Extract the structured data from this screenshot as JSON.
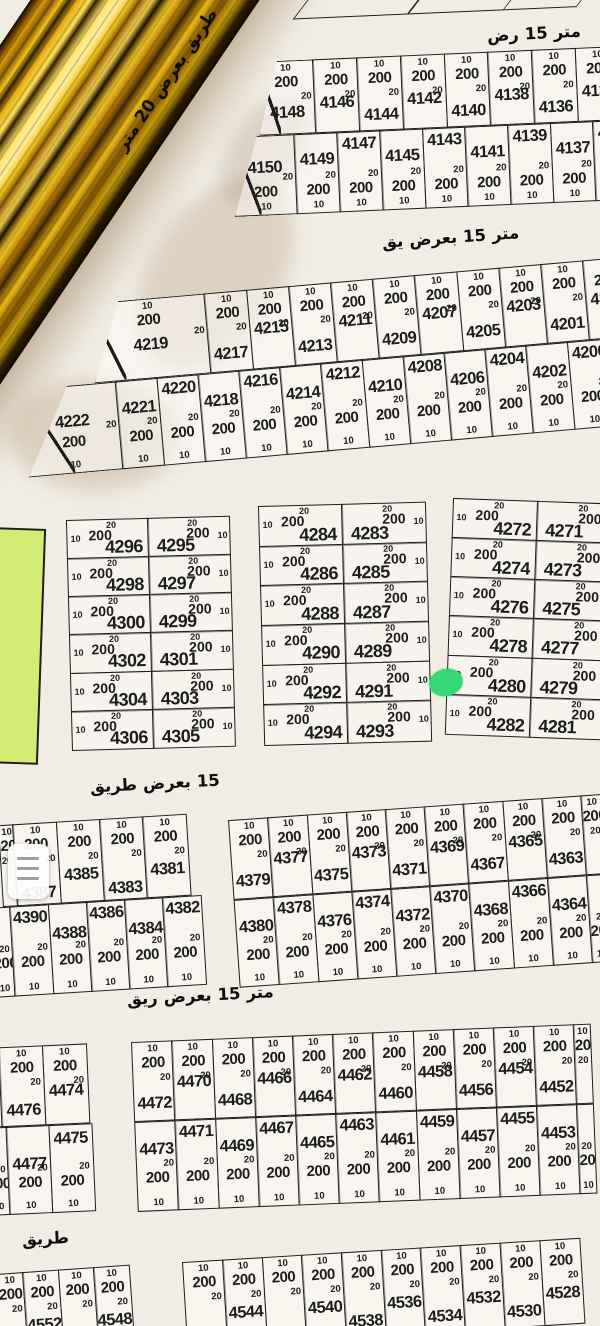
{
  "dims": {
    "frontage": "10",
    "area": "200",
    "depth": "20"
  },
  "colors": {
    "paper": "#f1ede5",
    "line": "#1d1d1d",
    "area_red": "#8e1b10",
    "green_rect": "#d3ec74",
    "marker_green": "#36d877",
    "gold_road": "#e8b113"
  },
  "roads": {
    "r20_diagonal": {
      "text": "طريق بعرض 20 متر"
    },
    "r15_top": {
      "words": [
        "رض",
        "15",
        "متر"
      ]
    },
    "r15_a": {
      "words": [
        "يق",
        "بعرض",
        "15",
        "متر"
      ]
    },
    "r15_b": {
      "words": [
        "طريق",
        "بعرض",
        "15"
      ]
    },
    "r15_c": {
      "words": [
        "ريق",
        "بعرض",
        "15",
        "متر"
      ]
    },
    "r_bottom": {
      "words": [
        "طريق"
      ]
    }
  },
  "menu_button": {
    "icon": "hamburger"
  },
  "marker": {
    "type": "highlight-dot",
    "near_plot": "4280"
  },
  "blocks": {
    "band_a": {
      "row_top": [
        "4148",
        "4146",
        "4144",
        "4142",
        "4140",
        "4138",
        "4136",
        "4134",
        "4132"
      ],
      "row_bottom": [
        "4150",
        "4149",
        "4147",
        "4145",
        "4143",
        "4141",
        "4139",
        "4137",
        "4135",
        "4133"
      ]
    },
    "band_b": {
      "row_top": [
        "4219",
        "4217",
        "4215",
        "4213",
        "4211",
        "4209",
        "4207",
        "4205",
        "4203",
        "4201",
        "4199",
        "4197",
        ""
      ],
      "row_bottom": [
        "4222",
        "4221",
        "4220",
        "4218",
        "4216",
        "4214",
        "4212",
        "4210",
        "4208",
        "4206",
        "4204",
        "4202",
        "4200",
        "4198",
        ""
      ]
    },
    "mid_left": {
      "rows": [
        [
          "4296",
          "4295"
        ],
        [
          "4298",
          "4297"
        ],
        [
          "4300",
          "4299"
        ],
        [
          "4302",
          "4301"
        ],
        [
          "4304",
          "4303"
        ],
        [
          "4306",
          "4305"
        ]
      ]
    },
    "mid_center": {
      "rows": [
        [
          "4284",
          "4283"
        ],
        [
          "4286",
          "4285"
        ],
        [
          "4288",
          "4287"
        ],
        [
          "4290",
          "4289"
        ],
        [
          "4292",
          "4291"
        ],
        [
          "4294",
          "4293"
        ]
      ]
    },
    "mid_right": {
      "rows": [
        [
          "4272",
          "4271"
        ],
        [
          "4274",
          "4273"
        ],
        [
          "4276",
          "4275"
        ],
        [
          "4278",
          "4277"
        ],
        [
          "4280",
          "4279"
        ],
        [
          "4282",
          "4281"
        ]
      ]
    },
    "band_c_left": {
      "row_top": [
        "",
        "4387",
        "4385",
        "4383",
        "4381"
      ],
      "row_bottom": [
        "",
        "4390",
        "4388",
        "4386",
        "4384",
        "4382"
      ]
    },
    "band_c_main": {
      "row_top": [
        "4379",
        "4377",
        "4375",
        "4373",
        "4371",
        "4369",
        "4367",
        "4365",
        "4363",
        ""
      ],
      "row_bottom": [
        "4380",
        "4378",
        "4376",
        "4374",
        "4372",
        "4370",
        "4368",
        "4366",
        "4364",
        ""
      ]
    },
    "band_d_left": {
      "row_top": [
        "4478",
        "4476",
        "4474"
      ],
      "row_bottom": [
        "4479",
        "4477",
        "4475"
      ]
    },
    "band_d_main": {
      "row_top": [
        "4472",
        "4470",
        "4468",
        "4466",
        "4464",
        "4462",
        "4460",
        "4458",
        "4456",
        "4454",
        "4452",
        ""
      ],
      "row_bottom": [
        "4473",
        "4471",
        "4469",
        "4467",
        "4465",
        "4463",
        "4461",
        "4459",
        "4457",
        "4455",
        "4453",
        ""
      ]
    },
    "band_e_left": {
      "row": [
        "",
        "4552",
        "",
        "4548"
      ]
    },
    "band_e_main": {
      "row": [
        "",
        "4544",
        "",
        "4540",
        "4538",
        "4536",
        "4534",
        "4532",
        "4530",
        "4528"
      ]
    }
  }
}
